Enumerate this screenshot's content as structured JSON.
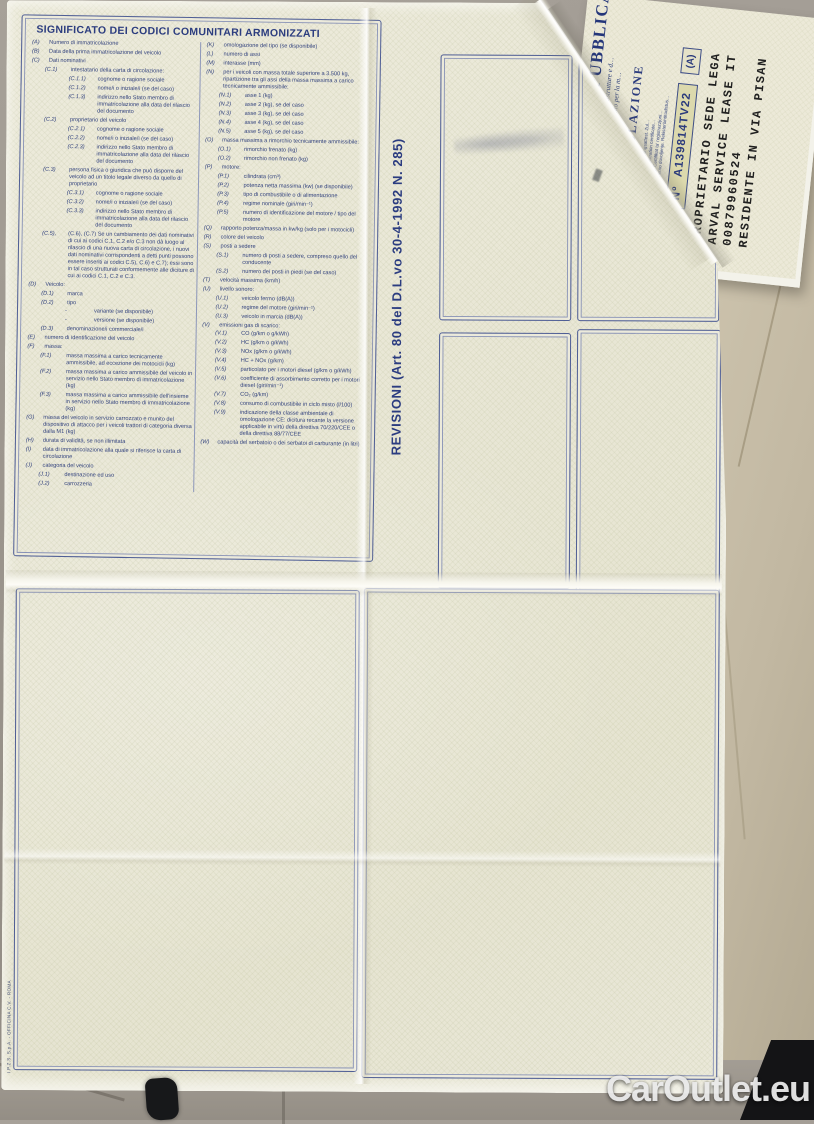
{
  "photo": {
    "watermark": "CarOutlet.eu"
  },
  "document": {
    "printer_imprint": "I.P.Z.S. S.p.A. - OFFICINA C.V. - ROMA",
    "legend": {
      "title": "SIGNIFICATO DEI CODICI COMUNITARI ARMONIZZATI",
      "left_column": [
        {
          "i": 0,
          "c": "(A)",
          "t": "Numero di immatricolazione"
        },
        {
          "i": 0,
          "c": "(B)",
          "t": "Data della prima immatricolazione del veicolo"
        },
        {
          "i": 0,
          "c": "(C)",
          "t": "Dati nominativi"
        },
        {
          "i": 1,
          "c": "(C.1)",
          "t": "intestatario della carta di circolazione:"
        },
        {
          "i": 2,
          "c": "(C.1.1)",
          "t": "cognome o ragione sociale"
        },
        {
          "i": 2,
          "c": "(C.1.2)",
          "t": "nome/i o iniziale/i (se del caso)"
        },
        {
          "i": 2,
          "c": "(C.1.3)",
          "t": "indirizzo nello Stato membro di immatricolazione alla data del rilascio del documento"
        },
        {
          "i": 1,
          "c": "(C.2)",
          "t": "proprietario del veicolo"
        },
        {
          "i": 2,
          "c": "(C.2.1)",
          "t": "cognome o ragione sociale"
        },
        {
          "i": 2,
          "c": "(C.2.2)",
          "t": "nome/i o iniziale/i (se del caso)"
        },
        {
          "i": 2,
          "c": "(C.2.3)",
          "t": "indirizzo nello Stato membro di immatricolazione alla data del rilascio del documento"
        },
        {
          "i": 1,
          "c": "(C.3)",
          "t": "persona fisica o giuridica che può disporre del veicolo ad un titolo legale diverso da quello di proprietario"
        },
        {
          "i": 2,
          "c": "(C.3.1)",
          "t": "cognome o ragione sociale"
        },
        {
          "i": 2,
          "c": "(C.3.2)",
          "t": "nome/i o iniziale/i (se del caso)"
        },
        {
          "i": 2,
          "c": "(C.3.3)",
          "t": "indirizzo nello Stato membro di immatricolazione alla data del rilascio del documento"
        },
        {
          "i": 1,
          "c": "(C.5),",
          "t": "(C.6), (C.7) Se un cambiamento dei dati nominativi di cui ai codici C.1, C.2 e/o C.3 non dà luogo al rilascio di una nuova carta di circolazione, i nuovi dati nominativi corrispondenti a detti punti possono essere inseriti ai codici C.5), C.6) e C.7); essi sono in tal caso strutturati conformemente alle diciture di cui ai codici C.1, C.2 e C.3."
        },
        {
          "i": 0,
          "c": "(D)",
          "t": "Veicolo:"
        },
        {
          "i": 1,
          "c": "(D.1)",
          "t": "marca"
        },
        {
          "i": 1,
          "c": "(D.2)",
          "t": "tipo"
        },
        {
          "i": 2,
          "c": "-",
          "t": "variante (se disponibile)"
        },
        {
          "i": 2,
          "c": "-",
          "t": "versione (se disponibile)"
        },
        {
          "i": 1,
          "c": "(D.3)",
          "t": "denominazione/i commerciale/i"
        },
        {
          "i": 0,
          "c": "(E)",
          "t": "numero di identificazione del veicolo"
        },
        {
          "i": 0,
          "c": "(F)",
          "t": "massa:"
        },
        {
          "i": 1,
          "c": "(F.1)",
          "t": "massa massima a carico tecnicamente ammissibile, ad eccezione dei motocicli (kg)"
        },
        {
          "i": 1,
          "c": "(F.2)",
          "t": "massa massima a carico ammissibile del veicolo in servizio nello Stato membro di immatricolazione (kg)"
        },
        {
          "i": 1,
          "c": "(F.3)",
          "t": "massa massima a carico ammissibile dell'insieme in servizio nello Stato membro di immatricolazione (kg)"
        },
        {
          "i": 0,
          "c": "(G)",
          "t": "massa del veicolo in servizio carrozzato e munito del dispositivo di attacco per i veicoli trattori di categoria diversa dalla M1 (kg)"
        },
        {
          "i": 0,
          "c": "(H)",
          "t": "durata di validità, se non illimitata"
        },
        {
          "i": 0,
          "c": "(I)",
          "t": "data di immatricolazione alla quale si riferisce la carta di circolazione"
        },
        {
          "i": 0,
          "c": "(J)",
          "t": "categoria del veicolo"
        },
        {
          "i": 1,
          "c": "(J.1)",
          "t": "destinazione ed uso"
        },
        {
          "i": 1,
          "c": "(J.2)",
          "t": "carrozzeria"
        }
      ],
      "right_column": [
        {
          "i": 0,
          "c": "(K)",
          "t": "omologazione del tipo (se disponibile)"
        },
        {
          "i": 0,
          "c": "(L)",
          "t": "numero di assi"
        },
        {
          "i": 0,
          "c": "(M)",
          "t": "interasse (mm)"
        },
        {
          "i": 0,
          "c": "(N)",
          "t": "per i veicoli con massa totale superiore a 3.500 kg, ripartizione tra gli assi della massa massima a carico tecnicamente ammissibile:"
        },
        {
          "i": 1,
          "c": "(N.1)",
          "t": "asse 1 (kg)"
        },
        {
          "i": 1,
          "c": "(N.2)",
          "t": "asse 2 (kg), se del caso"
        },
        {
          "i": 1,
          "c": "(N.3)",
          "t": "asse 3 (kg), se del caso"
        },
        {
          "i": 1,
          "c": "(N.4)",
          "t": "asse 4 (kg), se del caso"
        },
        {
          "i": 1,
          "c": "(N.5)",
          "t": "asse 5 (kg), se del caso"
        },
        {
          "i": 0,
          "c": "(O)",
          "t": "massa massima a rimorchio tecnicamente ammissibile:"
        },
        {
          "i": 1,
          "c": "(O.1)",
          "t": "rimorchio frenato (kg)"
        },
        {
          "i": 1,
          "c": "(O.2)",
          "t": "rimorchio non frenato (kg)"
        },
        {
          "i": 0,
          "c": "(P)",
          "t": "motore:"
        },
        {
          "i": 1,
          "c": "(P.1)",
          "t": "cilindrata (cm³)"
        },
        {
          "i": 1,
          "c": "(P.2)",
          "t": "potenza netta massima (kw) (se disponibile)"
        },
        {
          "i": 1,
          "c": "(P.3)",
          "t": "tipo di combustibile o di alimentazione"
        },
        {
          "i": 1,
          "c": "(P.4)",
          "t": "regime nominale (giri/min⁻¹)"
        },
        {
          "i": 1,
          "c": "(P.5)",
          "t": "numero di identificazione del motore / tipo del motore"
        },
        {
          "i": 0,
          "c": "(Q)",
          "t": "rapporto potenza/massa in kw/kg (solo per i motocicli)"
        },
        {
          "i": 0,
          "c": "(R)",
          "t": "colore del veicolo"
        },
        {
          "i": 0,
          "c": "(S)",
          "t": "posti a sedere"
        },
        {
          "i": 1,
          "c": "(S.1)",
          "t": "numero di posti a sedere, compreso quello del conducente"
        },
        {
          "i": 1,
          "c": "(S.2)",
          "t": "numero dei posti in piedi (se del caso)"
        },
        {
          "i": 0,
          "c": "(T)",
          "t": "velocità massima (km/h)"
        },
        {
          "i": 0,
          "c": "(U)",
          "t": "livello sonoro:"
        },
        {
          "i": 1,
          "c": "(U.1)",
          "t": "veicolo fermo (dB(A))"
        },
        {
          "i": 1,
          "c": "(U.2)",
          "t": "regime del motore (giri/min⁻¹)"
        },
        {
          "i": 1,
          "c": "(U.3)",
          "t": "veicolo in marcia (dB(A))"
        },
        {
          "i": 0,
          "c": "(V)",
          "t": "emissioni gas di scarico:"
        },
        {
          "i": 1,
          "c": "(V.1)",
          "t": "CO (g/km o g/kWh)"
        },
        {
          "i": 1,
          "c": "(V.2)",
          "t": "HC (g/km o g/kWh)"
        },
        {
          "i": 1,
          "c": "(V.3)",
          "t": "NOx (g/km o g/kWh)"
        },
        {
          "i": 1,
          "c": "(V.4)",
          "t": "HC + NOx (g/km)"
        },
        {
          "i": 1,
          "c": "(V.5)",
          "t": "particolato per i motori diesel (g/km o g/kWh)"
        },
        {
          "i": 1,
          "c": "(V.6)",
          "t": "coefficiente di assorbimento corretto per i motori diesel (giri/min⁻¹)"
        },
        {
          "i": 1,
          "c": "(V.7)",
          "t": "CO₂ (g/km)"
        },
        {
          "i": 1,
          "c": "(V.8)",
          "t": "consumo di combustibile in ciclo misto (l/100)"
        },
        {
          "i": 1,
          "c": "(V.9)",
          "t": "indicazione della classe ambientale di omologazione CE: dicitura recante la versione applicabile in virtù della direttiva 70/220/CEE o della direttiva 88/77/CEE"
        },
        {
          "i": 0,
          "c": "(W)",
          "t": "capacità del serbatoio o dei serbatoi di carburante (in litri)"
        }
      ]
    },
    "revisioni": {
      "label": "REVISIONI (Art. 80 del D.L.vo 30-4-1992 N. 285)"
    },
    "cover": {
      "title_fragment": "REPUBBLICA",
      "ministry_line_1": "…ro delle infrastrutture e d…",
      "ministry_line_2": "Dipartimento per la m…",
      "doc_type": "CARTA DI CIRCOLAZIONE",
      "multilingual_lines": [
        "…de circulación. Osvědčení o registraci. Registreringsattest. Zul…",
        "…κυκλοφορίας. Πιστοποιητικό Εγγραφής. Registration certificate…",
        "Registracijos liudijimas. Forgalmi engedély. Ċertifikat ta' reġistrazzjoni…",
        "matrícula. Osvedčenie o evidencii. Prometno dovoljenje. Rekisteröintitodistus…"
      ],
      "number_label": "Nº",
      "number_value": "A139814TV22",
      "section_marker": "(A)",
      "typewritten_lines": [
        "PROPRIETARIO SEDE LEGA",
        "ARVAL SERVICE LEASE IT",
        "00879960524",
        "RESIDENTE IN VIA PISAN"
      ]
    },
    "colors": {
      "navy_print": "#2c3d7f",
      "paper_cream": "#eae8d7",
      "number_box_bg": "#dcd9ad",
      "floor_beige": "#c8bfa9",
      "floor_grey": "#9a948c"
    }
  }
}
